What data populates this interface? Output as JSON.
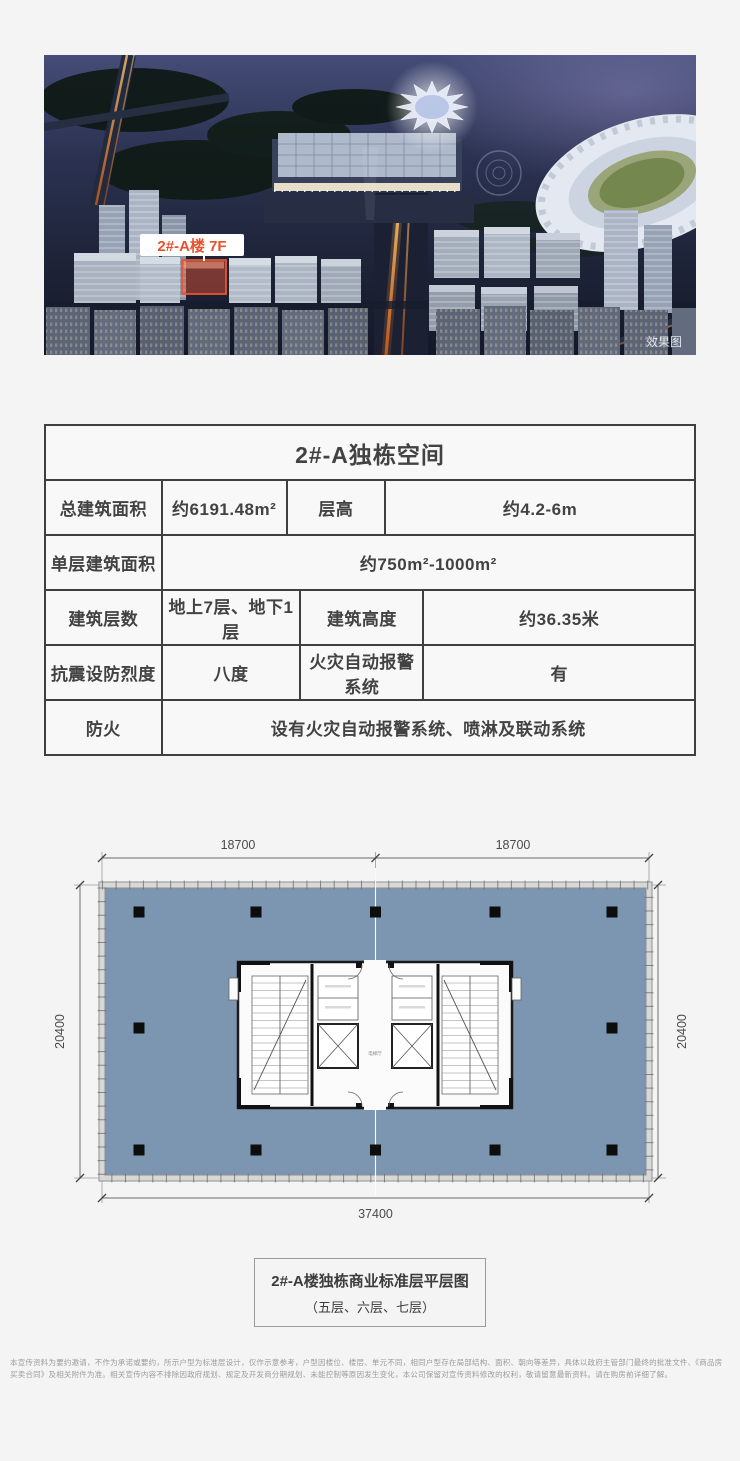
{
  "hero": {
    "building_label": "2#-A楼 7F",
    "watermark": "效果图",
    "accent_color": "#e8512d"
  },
  "spec_table": {
    "title": "2#-A独栋空间",
    "rows": [
      {
        "c0": "总建筑面积",
        "c1": "约6191.48m²",
        "c2": "层高",
        "c3": "约4.2-6m"
      },
      {
        "c0": "单层建筑面积",
        "c1": "约750m²-1000m²"
      },
      {
        "c0": "建筑层数",
        "c1": "地上7层、地下1层",
        "c2": "建筑高度",
        "c3": "约36.35米"
      },
      {
        "c0": "抗震设防烈度",
        "c1": "八度",
        "c2": "火灾自动报警系统",
        "c3": "有"
      },
      {
        "c0": "防火",
        "c1": "设有火灾自动报警系统、喷淋及联动系统"
      }
    ]
  },
  "floor_plan": {
    "dim_top_left": "18700",
    "dim_top_right": "18700",
    "dim_left": "20400",
    "dim_right": "20400",
    "dim_bottom": "37400",
    "core_label": "电梯厅",
    "floor_color": "#7c96b2"
  },
  "caption": {
    "line1": "2#-A楼独栋商业标准层平层图",
    "line2": "（五层、六层、七层）"
  },
  "disclaimer": "本宣传资料为要约邀请，不作为承诺或要约，所示户型为标准层设计，仅作示意参考，户型因楼位、楼层、单元不同，相同户型存在局部结构、面积、朝向等差异，具体以政府主管部门最终的批准文件、《商品房买卖合同》及相关附件为准。相关宣传内容不排除因政府规划、规定及开发商分期规划、未能控制等原因发生变化，本公司保留对宣传资料修改的权利，敬请留意最新资料。请在购房前详细了解。"
}
